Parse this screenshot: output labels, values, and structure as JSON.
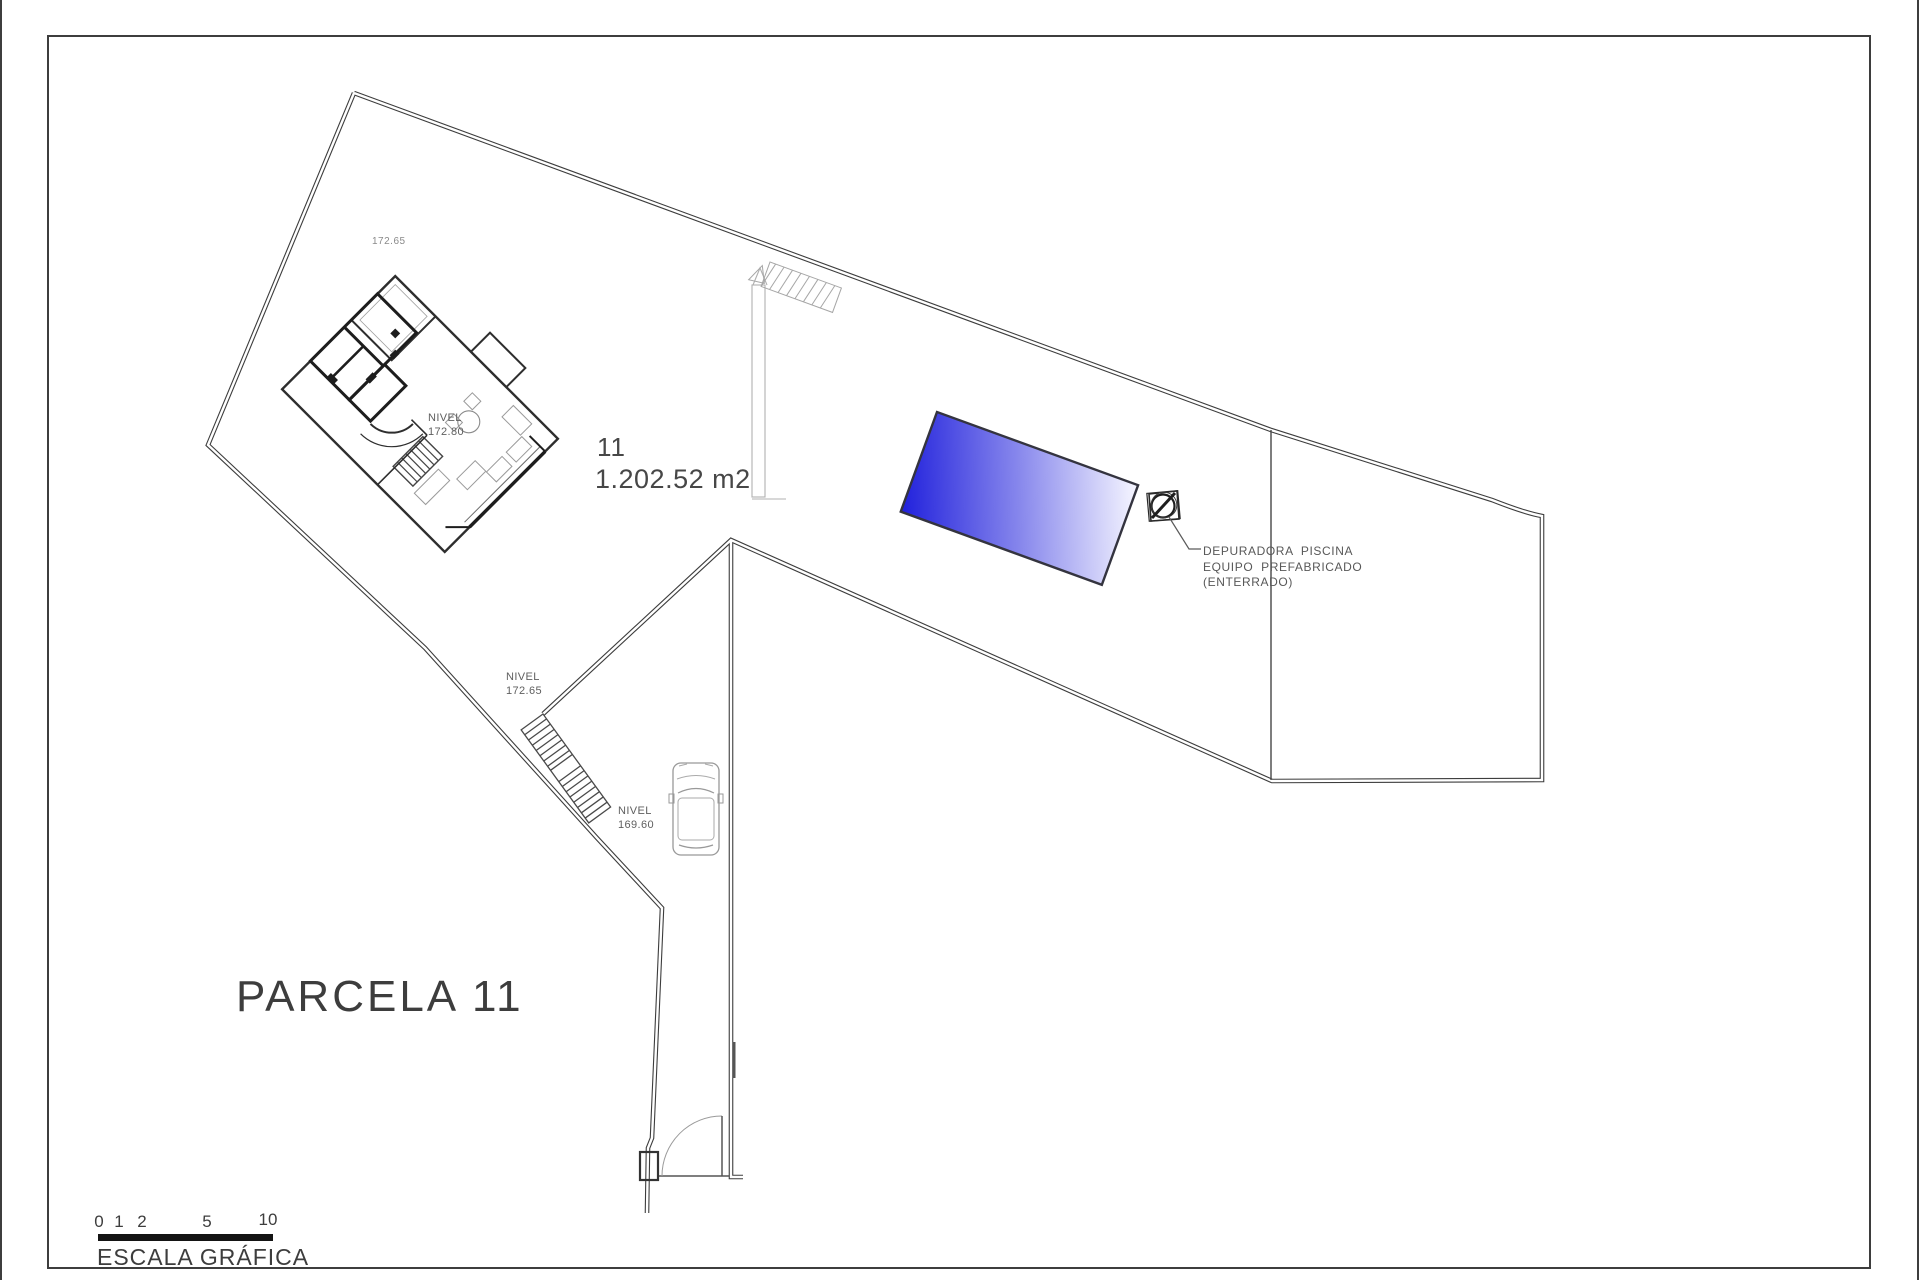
{
  "labels": {
    "elevation_top": "172.65",
    "nivel_house": {
      "line1": "NIVEL",
      "line2": "172.80"
    },
    "nivel_mid": {
      "line1": "NIVEL",
      "line2": "172.65"
    },
    "nivel_low": {
      "line1": "NIVEL",
      "line2": "169.60"
    },
    "parcel_number": "11",
    "parcel_area": "1.202.52 m2",
    "pool_note": {
      "line1": "DEPURADORA  PISCINA",
      "line2": "EQUIPO  PREFABRICADO",
      "line3": "(ENTERRADO)"
    },
    "parcel_title": "PARCELA 11"
  },
  "scale_bar": {
    "ticks": [
      "0",
      "1",
      "2",
      "5",
      "10"
    ],
    "caption": "ESCALA GRÁFICA"
  },
  "colors": {
    "pool_deep": "#2020dc",
    "pool_mid": "#8686ec",
    "pool_light": "#f4f4ff",
    "line": "#3d3d3d",
    "text": "#555555"
  }
}
